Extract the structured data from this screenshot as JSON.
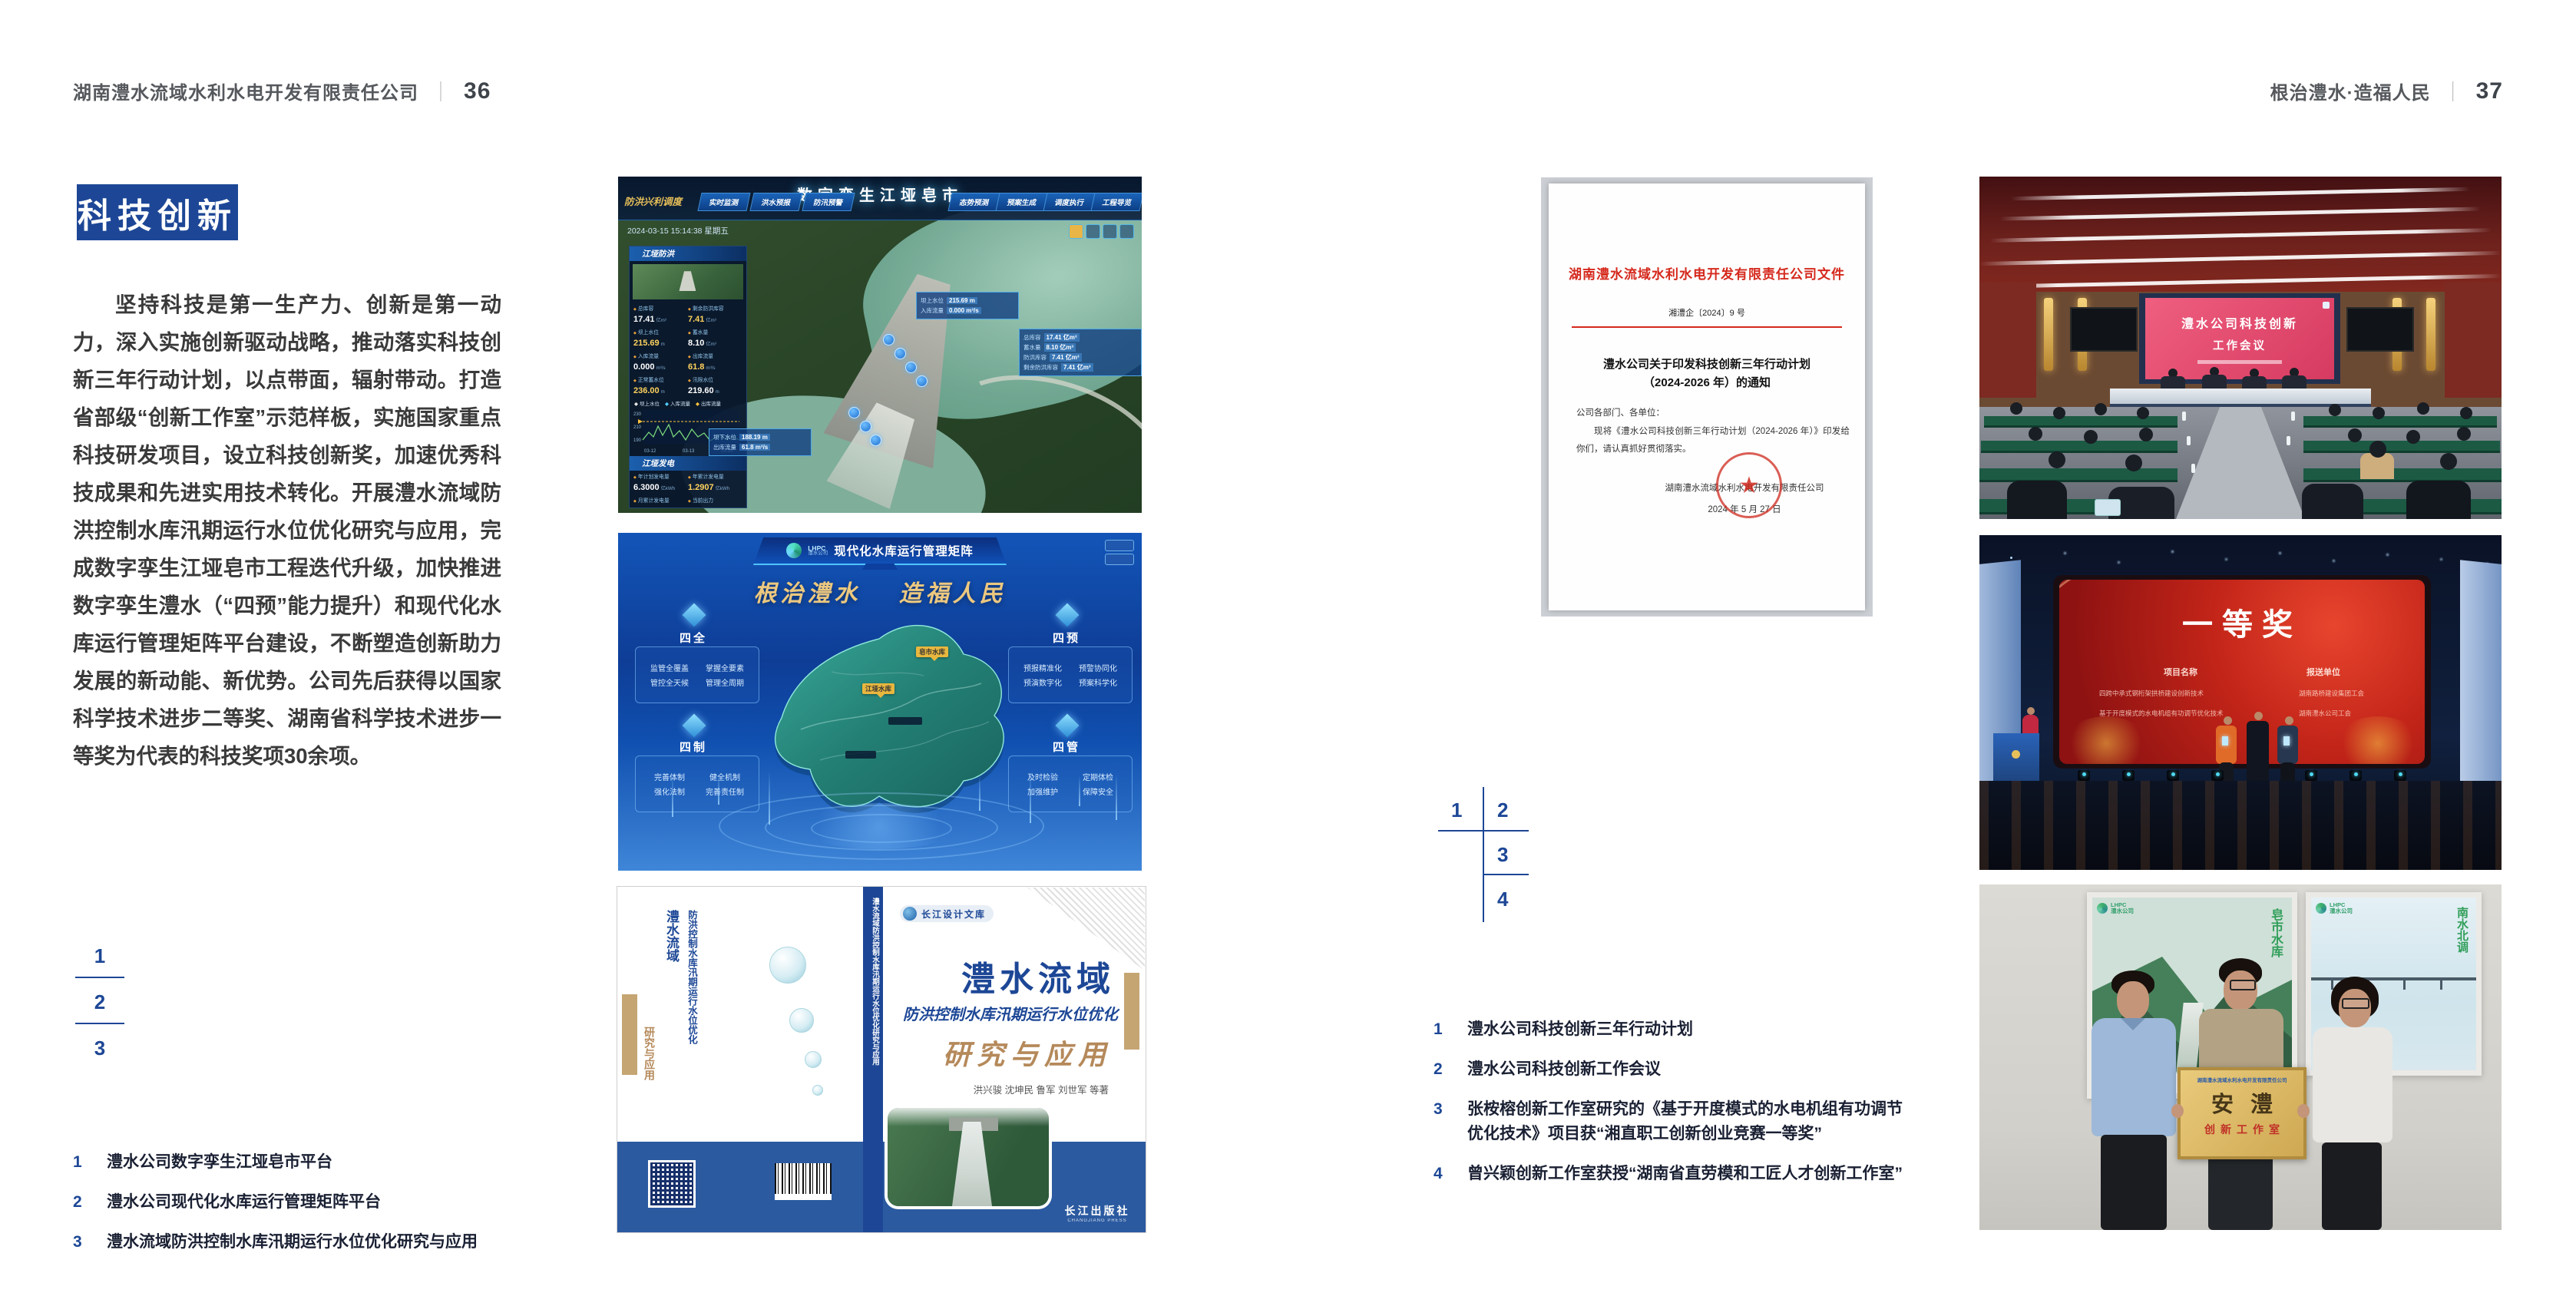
{
  "meta": {
    "accent_blue": "#1d4796",
    "doc_red": "#d5281c",
    "caption_ink": "#1a2033",
    "separator": "｜"
  },
  "left_page": {
    "header": {
      "company": "湖南澧水流域水利水电开发有限责任公司",
      "page": "36"
    },
    "section_title": "科技创新",
    "body": "坚持科技是第一生产力、创新是第一动力，深入实施创新驱动战略，推动落实科技创新三年行动计划，以点带面，辐射带动。打造省部级“创新工作室”示范样板，实施国家重点科技研发项目，设立科技创新奖，加速优秀科技成果和先进实用技术转化。开展澧水流域防洪控制水库汛期运行水位优化研究与应用，完成数字孪生江垭皂市工程迭代升级，加快推进数字孪生澧水（“四预”能力提升）和现代化水库运行管理矩阵平台建设，不断塑造创新助力发展的新动能、新优势。公司先后获得以国家科学技术进步二等奖、湖南省科学技术进步一等奖为代表的科技奖项30余项。",
    "index": {
      "n1": "1",
      "n2": "2",
      "n3": "3"
    },
    "captions": [
      {
        "n": "1",
        "t": "澧水公司数字孪生江垭皂市平台"
      },
      {
        "n": "2",
        "t": "澧水公司现代化水库运行管理矩阵平台"
      },
      {
        "n": "3",
        "t": "澧水流域防洪控制水库汛期运行水位优化研究与应用"
      }
    ]
  },
  "right_page": {
    "header": {
      "slogan": "根治澧水·造福人民",
      "page": "37"
    },
    "index": {
      "n1": "1",
      "n2": "2",
      "n3": "3",
      "n4": "4"
    },
    "captions": [
      {
        "n": "1",
        "t": "澧水公司科技创新三年行动计划"
      },
      {
        "n": "2",
        "t": "澧水公司科技创新工作会议"
      },
      {
        "n": "3",
        "t": "张桉榕创新工作室研究的《基于开度模式的水电机组有功调节",
        "t2": "优化技术》项目获“湘直职工创新创业竞赛一等奖”"
      },
      {
        "n": "4",
        "t": "曾兴颖创新工作室获授“湖南省直劳模和工匠人才创新工作室”"
      }
    ]
  },
  "dash": {
    "label": "防洪兴利调度",
    "tabs_left": [
      "实时监测",
      "洪水预报",
      "防汛预警"
    ],
    "title": "数字孪生江垭皂市",
    "tabs_right": [
      "态势预测",
      "预案生成",
      "调度执行",
      "工程导览"
    ],
    "datetime": "2024-03-15 15:14:38 星期五",
    "panel1": "江垭防洪",
    "stats1": [
      {
        "l": "总库容",
        "v": "17.41",
        "u": "亿m³"
      },
      {
        "l": "剩余防洪库容",
        "v": "7.41",
        "u": "亿m³"
      },
      {
        "l": "坝上水位",
        "v": "215.69",
        "u": "m"
      },
      {
        "l": "蓄水量",
        "v": "8.10",
        "u": "亿m³"
      },
      {
        "l": "入库流量",
        "v": "0.000",
        "u": "m³/s"
      },
      {
        "l": "出库流量",
        "v": "61.8",
        "u": "m³/s"
      },
      {
        "l": "正常蓄水位",
        "v": "236.00",
        "u": "m"
      },
      {
        "l": "汛限水位",
        "v": "219.60",
        "u": "m"
      }
    ],
    "legend": [
      "坝上水位",
      "入库流量",
      "出库流量"
    ],
    "yticks": [
      "230",
      "210",
      "190"
    ],
    "xticks": [
      "03-12",
      "03-13",
      "03-14"
    ],
    "panel2": "江垭发电",
    "stats2": [
      {
        "l": "年计划发电量",
        "v": "6.3000",
        "u": "亿kWh"
      },
      {
        "l": "年累计发电量",
        "v": "1.2907",
        "u": "亿kWh"
      },
      {
        "l": "月累计发电量",
        "v": "3359.21",
        "u": "万kWh"
      },
      {
        "l": "当前出力",
        "v": "0.00",
        "u": "MW"
      },
      {
        "l": "发电流量",
        "v": "0.00",
        "u": "m³/s"
      },
      {
        "l": "弃水流量",
        "v": "0.00",
        "u": "m³/s"
      }
    ],
    "gauge_vals": [
      "0.00",
      "102.98",
      "0.00"
    ],
    "bubble1": [
      {
        "l": "坝上水位",
        "v": "215.69 m"
      },
      {
        "l": "入库流量",
        "v": "0.000 m³/s"
      }
    ],
    "bubble2": [
      {
        "l": "总库容",
        "v": "17.41 亿m³"
      },
      {
        "l": "蓄水量",
        "v": "8.10 亿m³"
      },
      {
        "l": "防洪库容",
        "v": "7.41 亿m³"
      },
      {
        "l": "剩余防洪库容",
        "v": "7.41 亿m³"
      }
    ],
    "bubble3": [
      {
        "l": "坝下水位",
        "v": "188.19 m"
      },
      {
        "l": "出库流量",
        "v": "61.8 m³/s"
      }
    ]
  },
  "plat": {
    "logo_en": "LHPC",
    "logo_cn": "澧水公司",
    "title": "现代化水库运行管理矩阵",
    "slogan1": "根治澧水",
    "slogan2": "造福人民",
    "panels": [
      {
        "name": "四全",
        "items": [
          "监管全覆盖",
          "掌握全要素",
          "管控全天候",
          "管理全周期"
        ]
      },
      {
        "name": "四预",
        "items": [
          "预报精准化",
          "预警协同化",
          "预演数字化",
          "预案科学化"
        ]
      },
      {
        "name": "四制",
        "items": [
          "完善体制",
          "健全机制",
          "强化法制",
          "完善责任制"
        ]
      },
      {
        "name": "四管",
        "items": [
          "及时检验",
          "定期体检",
          "加强维护",
          "保障安全"
        ]
      }
    ],
    "map_labels": [
      "皂市水库",
      "江垭水库"
    ]
  },
  "book": {
    "series": "长江设计文库",
    "t1": "澧水流域",
    "t2": "防洪控制水库汛期运行水位优化",
    "t3": "研究与应用",
    "authors": "洪兴骏  沈坤民  鲁军  刘世军  等著",
    "spine": "澧水流域防洪控制水库汛期运行水位优化研究与应用",
    "publisher": "长江出版社",
    "publisher_en": "CHANGJIANG PRESS"
  },
  "doc": {
    "header": "湖南澧水流域水利水电开发有限责任公司文件",
    "number": "湘澧企〔2024〕9 号",
    "title1": "澧水公司关于印发科技创新三年行动计划",
    "title2": "（2024-2026 年）的通知",
    "salute": "公司各部门、各单位：",
    "body": "现将《澧水公司科技创新三年行动计划（2024-2026 年）》印发给你们，请认真抓好贯彻落实。",
    "signer": "湖南澧水流域水利水电开发有限责任公司",
    "date": "2024 年 5 月 27 日"
  },
  "meeting": {
    "line1": "澧水公司科技创新",
    "line2": "工作会议"
  },
  "award": {
    "title": "一等奖",
    "col1": "项目名称",
    "col2": "报送单位",
    "rows": [
      {
        "p": "四跨中承式钢桁架拱桥建设创新技术",
        "u": "湖南路桥建设集团工会"
      },
      {
        "p": "基于开度模式的水电机组有功调节优化技术",
        "u": "湖南澧水公司工会"
      }
    ]
  },
  "group": {
    "plaque_header": "湖南澧水流域水利水电开发有限责任公司",
    "plaque_title": "安澧",
    "plaque_sub": "创新工作室",
    "posterL_text": "皂市水库",
    "posterR_text": "南水北调",
    "logo_en": "LHPC",
    "logo_cn": "澧水公司"
  },
  "icons": {
    "star": "★",
    "clock_dot": "●"
  }
}
